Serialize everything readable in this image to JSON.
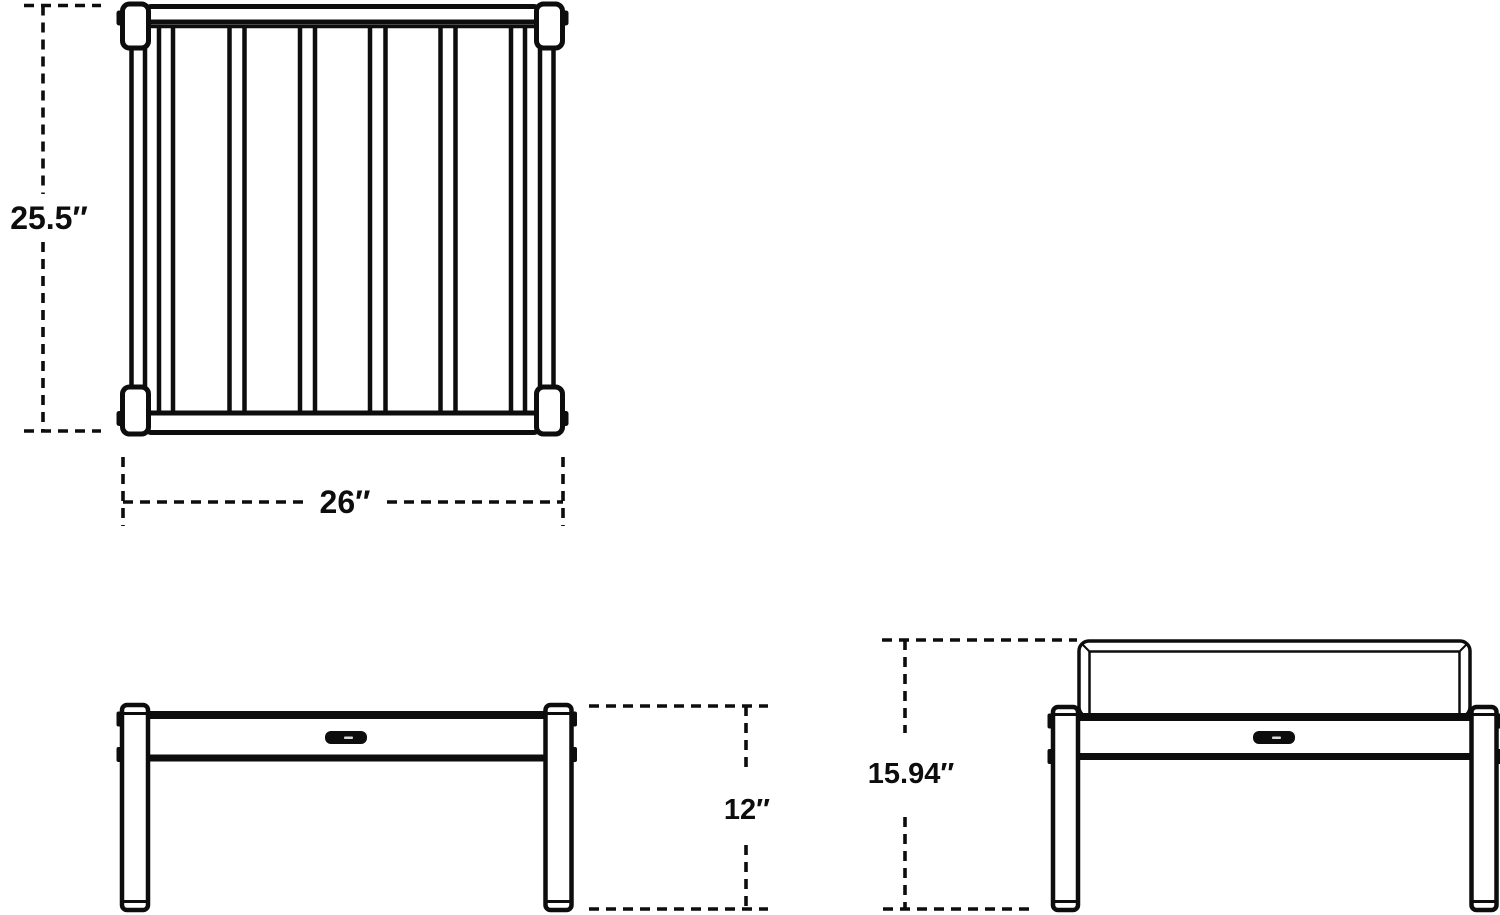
{
  "dimensions": {
    "depth": "25.5″",
    "width": "26″",
    "seat_height": "12″",
    "overall_height": "15.94″"
  },
  "colors": {
    "line": "#0d0d0d",
    "background": "#ffffff"
  }
}
